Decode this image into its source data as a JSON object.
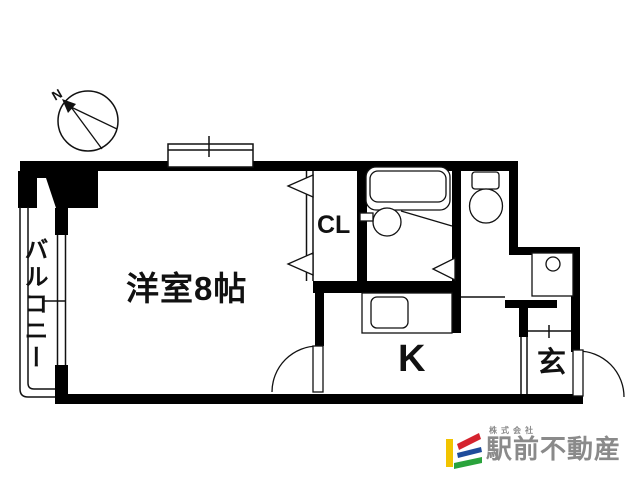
{
  "plan": {
    "balcony_label": "バルコニー",
    "living_label": "洋室8帖",
    "closet_label": "CL",
    "kitchen_label": "K",
    "entrance_label": "玄",
    "compass_north": "N"
  },
  "logo": {
    "company_prefix": "株式会社",
    "company_name": "駅前不動産",
    "mark_yellow": "#f2c400",
    "mark_red": "#d5232e",
    "mark_blue": "#1e4b9b",
    "mark_green": "#2aa33c",
    "text_color": "#8a8a8a"
  },
  "canvas": {
    "bg": "#ffffff",
    "ink": "#000000"
  }
}
